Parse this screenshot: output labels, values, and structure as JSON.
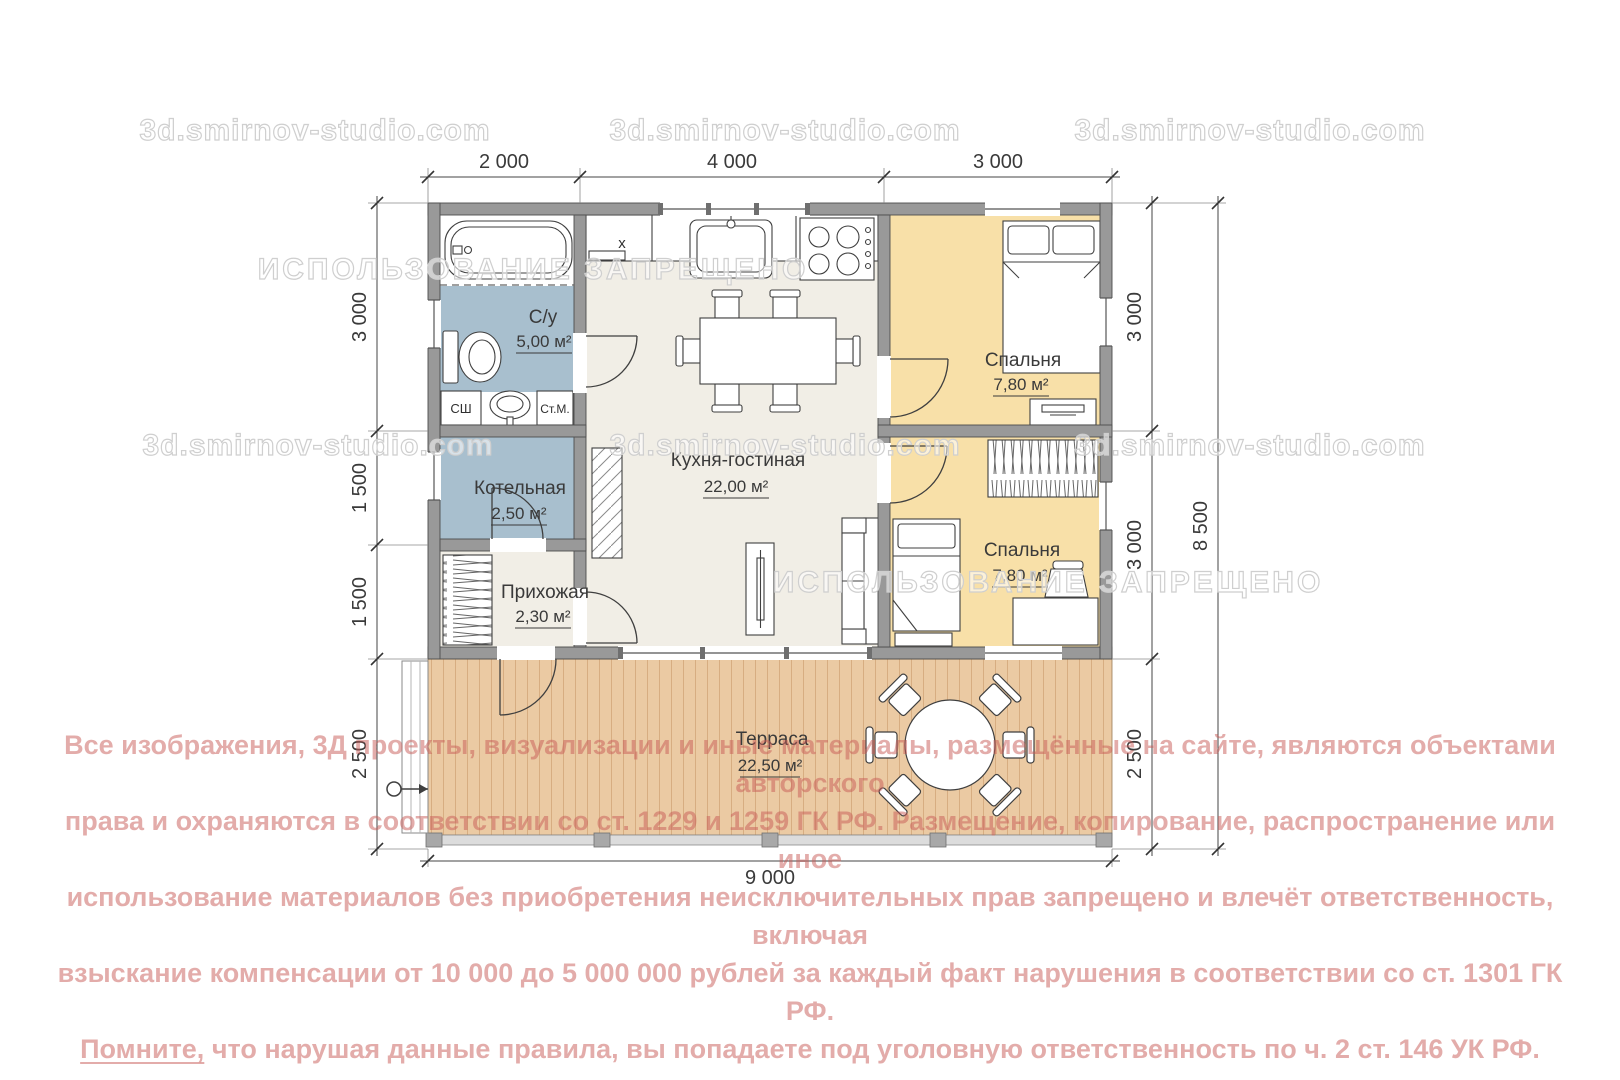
{
  "watermarks": {
    "site": "3d.smirnov-studio.com",
    "ban": "ИСПОЛЬЗОВАНИЕ ЗАПРЕЩЕНО"
  },
  "copyright": {
    "lines": [
      "Все изображения, 3Д проекты, визуализации и иные материалы, размещённые на сайте, являются объектами авторского",
      "права и охраняются в соответствии со ст. 1229 и 1259 ГК РФ. Размещение, копирование, распространение или иное",
      "использование материалов без приобретения неисключительных прав запрещено и влечёт ответственность, включая",
      "взыскание компенсации от 10 000 до 5 000 000 рублей за каждый факт нарушения в соответствии со ст. 1301 ГК РФ."
    ],
    "line5_emphasis": "Помните,",
    "line5_rest": " что нарушая данные правила, вы попадаете под уголовную ответственность по ч. 2 ст. 146 УК РФ."
  },
  "rooms": {
    "bathroom": {
      "name": "С/у",
      "area": "5,00 м²"
    },
    "boiler": {
      "name": "Котельная",
      "area": "2,50 м²"
    },
    "hallway": {
      "name": "Прихожая",
      "area": "2,30 м²"
    },
    "kitchen_living": {
      "name": "Кухня-гостиная",
      "area": "22,00 м²"
    },
    "bedroom_1": {
      "name": "Спальня",
      "area": "7,80 м²"
    },
    "bedroom_2": {
      "name": "Спальня",
      "area": "7,80 м²"
    },
    "terrace": {
      "name": "Терраса",
      "area": "22,50 м²"
    }
  },
  "fixtures": {
    "drying_cabinet": "СШ",
    "washing_machine": "Ст.М.",
    "fridge_mark": "x"
  },
  "dimensions": {
    "top": [
      "2 000",
      "4 000",
      "3 000"
    ],
    "left": [
      "3 000",
      "1 500",
      "1 500",
      "2 500"
    ],
    "right_inner": [
      "3 000",
      "3 000",
      "2 500"
    ],
    "right_total": "8 500",
    "bottom": "9 000"
  },
  "colors": {
    "wet_room_floor": "#a8bfce",
    "bedroom_floor": "#f8e0a8",
    "living_floor": "#f1eee6",
    "terrace_wood": "#ebcaa3",
    "wall": "#999999",
    "copyright_text": "#c75a56",
    "watermark_outline": "#cfcfcf"
  }
}
